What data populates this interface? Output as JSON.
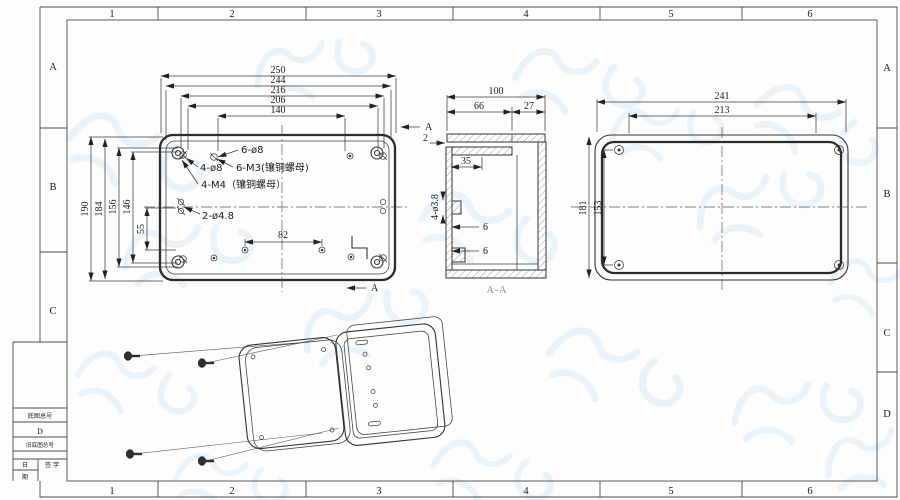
{
  "sheet": {
    "columns": [
      "1",
      "2",
      "3",
      "4",
      "5",
      "6"
    ],
    "rows_left": [
      "A",
      "B",
      "C"
    ],
    "rows_right": [
      "A",
      "B",
      "C",
      "D"
    ],
    "title_block": {
      "master_no_label": "底图总号",
      "master_no_value": "D",
      "old_master_no_label": "旧底图总号",
      "date_char_top": "日",
      "date_char_bottom": "期",
      "sign_label": "签 字"
    }
  },
  "lid_view": {
    "dims_top": [
      "250",
      "244",
      "216",
      "206",
      "140"
    ],
    "dims_left": [
      "190",
      "184",
      "156",
      "146",
      "55"
    ],
    "dim_hole_span": "82",
    "note_6_d8": "6-ø8",
    "note_4_d8": "4-ø8",
    "note_6_m3": "6-M3(镶铜螺母)",
    "note_4_m4": "4-M4（镶铜螺母）",
    "note_2_d48": "2-ø4.8",
    "section_label": "A"
  },
  "section_view": {
    "dim_width": "100",
    "dim_66": "66",
    "dim_27": "27",
    "dim_lid": "2",
    "dim_35": "35",
    "note_holes": "4-ø3.8",
    "dim_6_upper": "6",
    "dim_6_lower": "6",
    "title": "A-A"
  },
  "face_view": {
    "dim_241": "241",
    "dim_213": "213",
    "dim_181": "181",
    "dim_153": "153"
  }
}
